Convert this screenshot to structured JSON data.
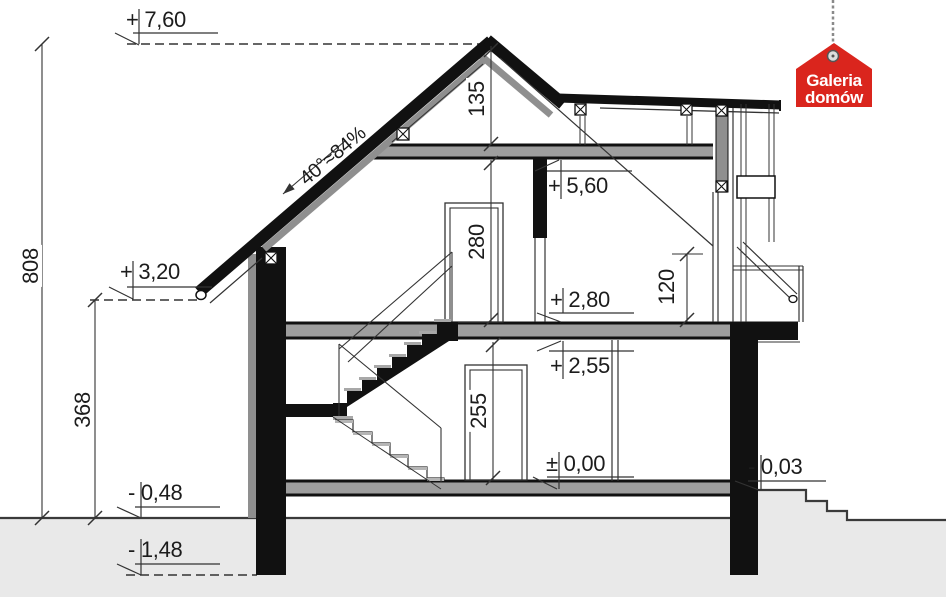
{
  "drawing": {
    "kind": "house-cross-section",
    "levels": [
      {
        "label": "+ 7,60"
      },
      {
        "label": "+ 3,20"
      },
      {
        "label": "- 0,48"
      },
      {
        "label": "- 1,48"
      },
      {
        "label": "+ 5,60"
      },
      {
        "label": "+ 2,80"
      },
      {
        "label": "+ 2,55"
      },
      {
        "label": "± 0,00"
      },
      {
        "label": "- 0,03"
      }
    ],
    "dimensions": {
      "total_height": "808",
      "lower_part_height": "368",
      "ridge_to_ceiling": "135",
      "upper_room_height": "280",
      "ground_room_height": "255",
      "railing_height": "120"
    },
    "roof_slope": {
      "label": "40°≈84%"
    }
  },
  "logo": {
    "line1": "Galeria",
    "line2": "domów"
  },
  "colors": {
    "ink": "#1a1a1a",
    "thin_line": "#333333",
    "slab_gray": "#9e9e9e",
    "insulation_gray": "#8f8f8f",
    "ground_gray": "#e9e9e9",
    "logo_red": "#da251d"
  }
}
